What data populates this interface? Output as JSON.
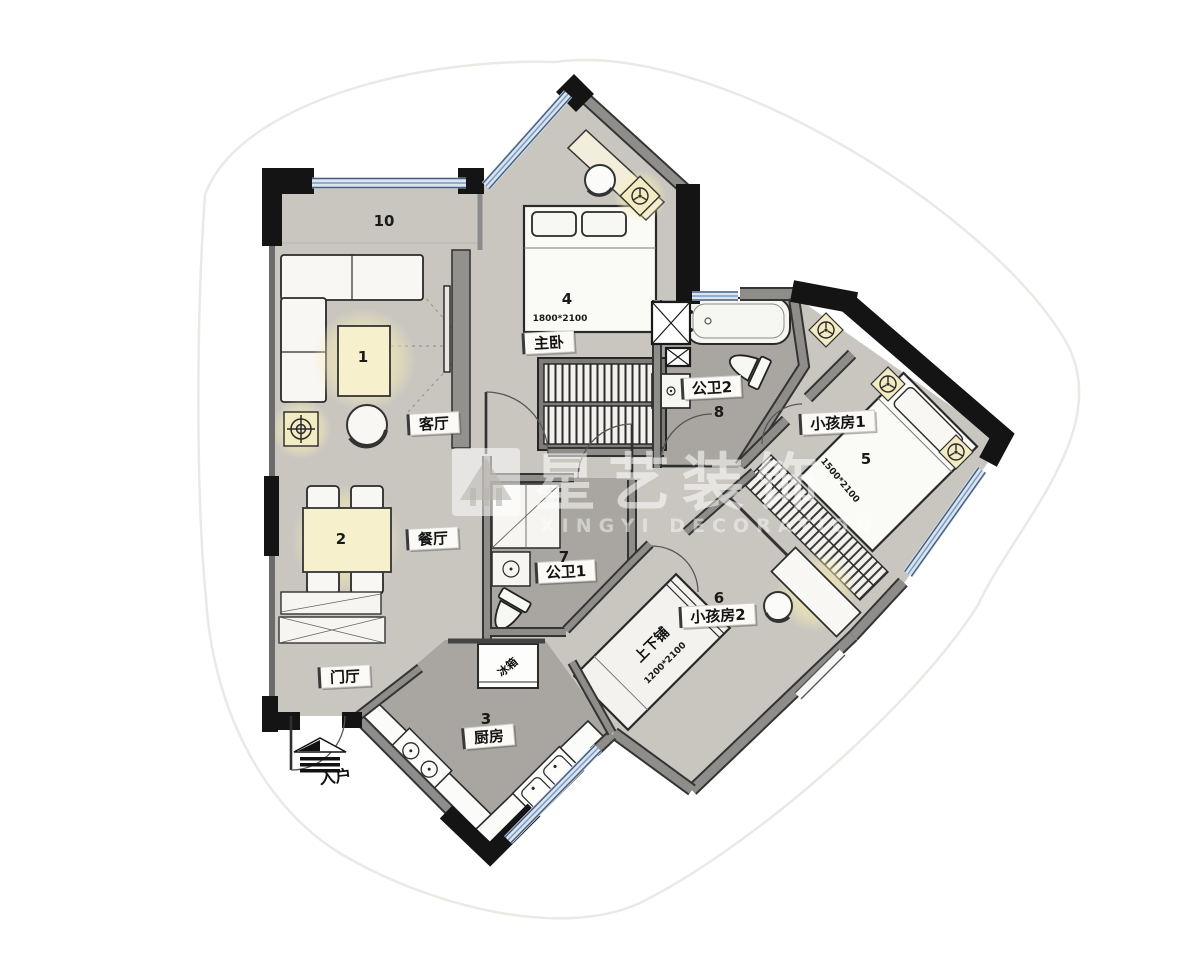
{
  "watermark": {
    "brand": "星艺装饰",
    "subtitle": "XINGYI DECORATION"
  },
  "labels": {
    "living": "客厅",
    "dining": "餐厅",
    "hall": "门厅",
    "kitchen": "厨房",
    "master": "主卧",
    "bath1": "公卫1",
    "bath2": "公卫2",
    "kids1": "小孩房1",
    "kids2": "小孩房2",
    "bunk": "上下铺",
    "entry": "入户",
    "fridge": "冰箱"
  },
  "numbers": {
    "coffee_table": "1",
    "dining_table": "2",
    "kitchen": "3",
    "master": "4",
    "kids1": "5",
    "kids2": "6",
    "bath1": "7",
    "bath2": "8",
    "balcony": "10"
  },
  "dimensions": {
    "master_bed": "1800*2100",
    "kids1_bed": "1500*2100",
    "bunk_bed": "1200*2100"
  },
  "colors": {
    "floor": "#c9c6c0",
    "wet_floor": "#a9a6a1",
    "wall_black": "#141414",
    "wall_gray": "#8f8d8a",
    "window_blue": "#d9e5f2",
    "glow": "#f6edbe"
  }
}
